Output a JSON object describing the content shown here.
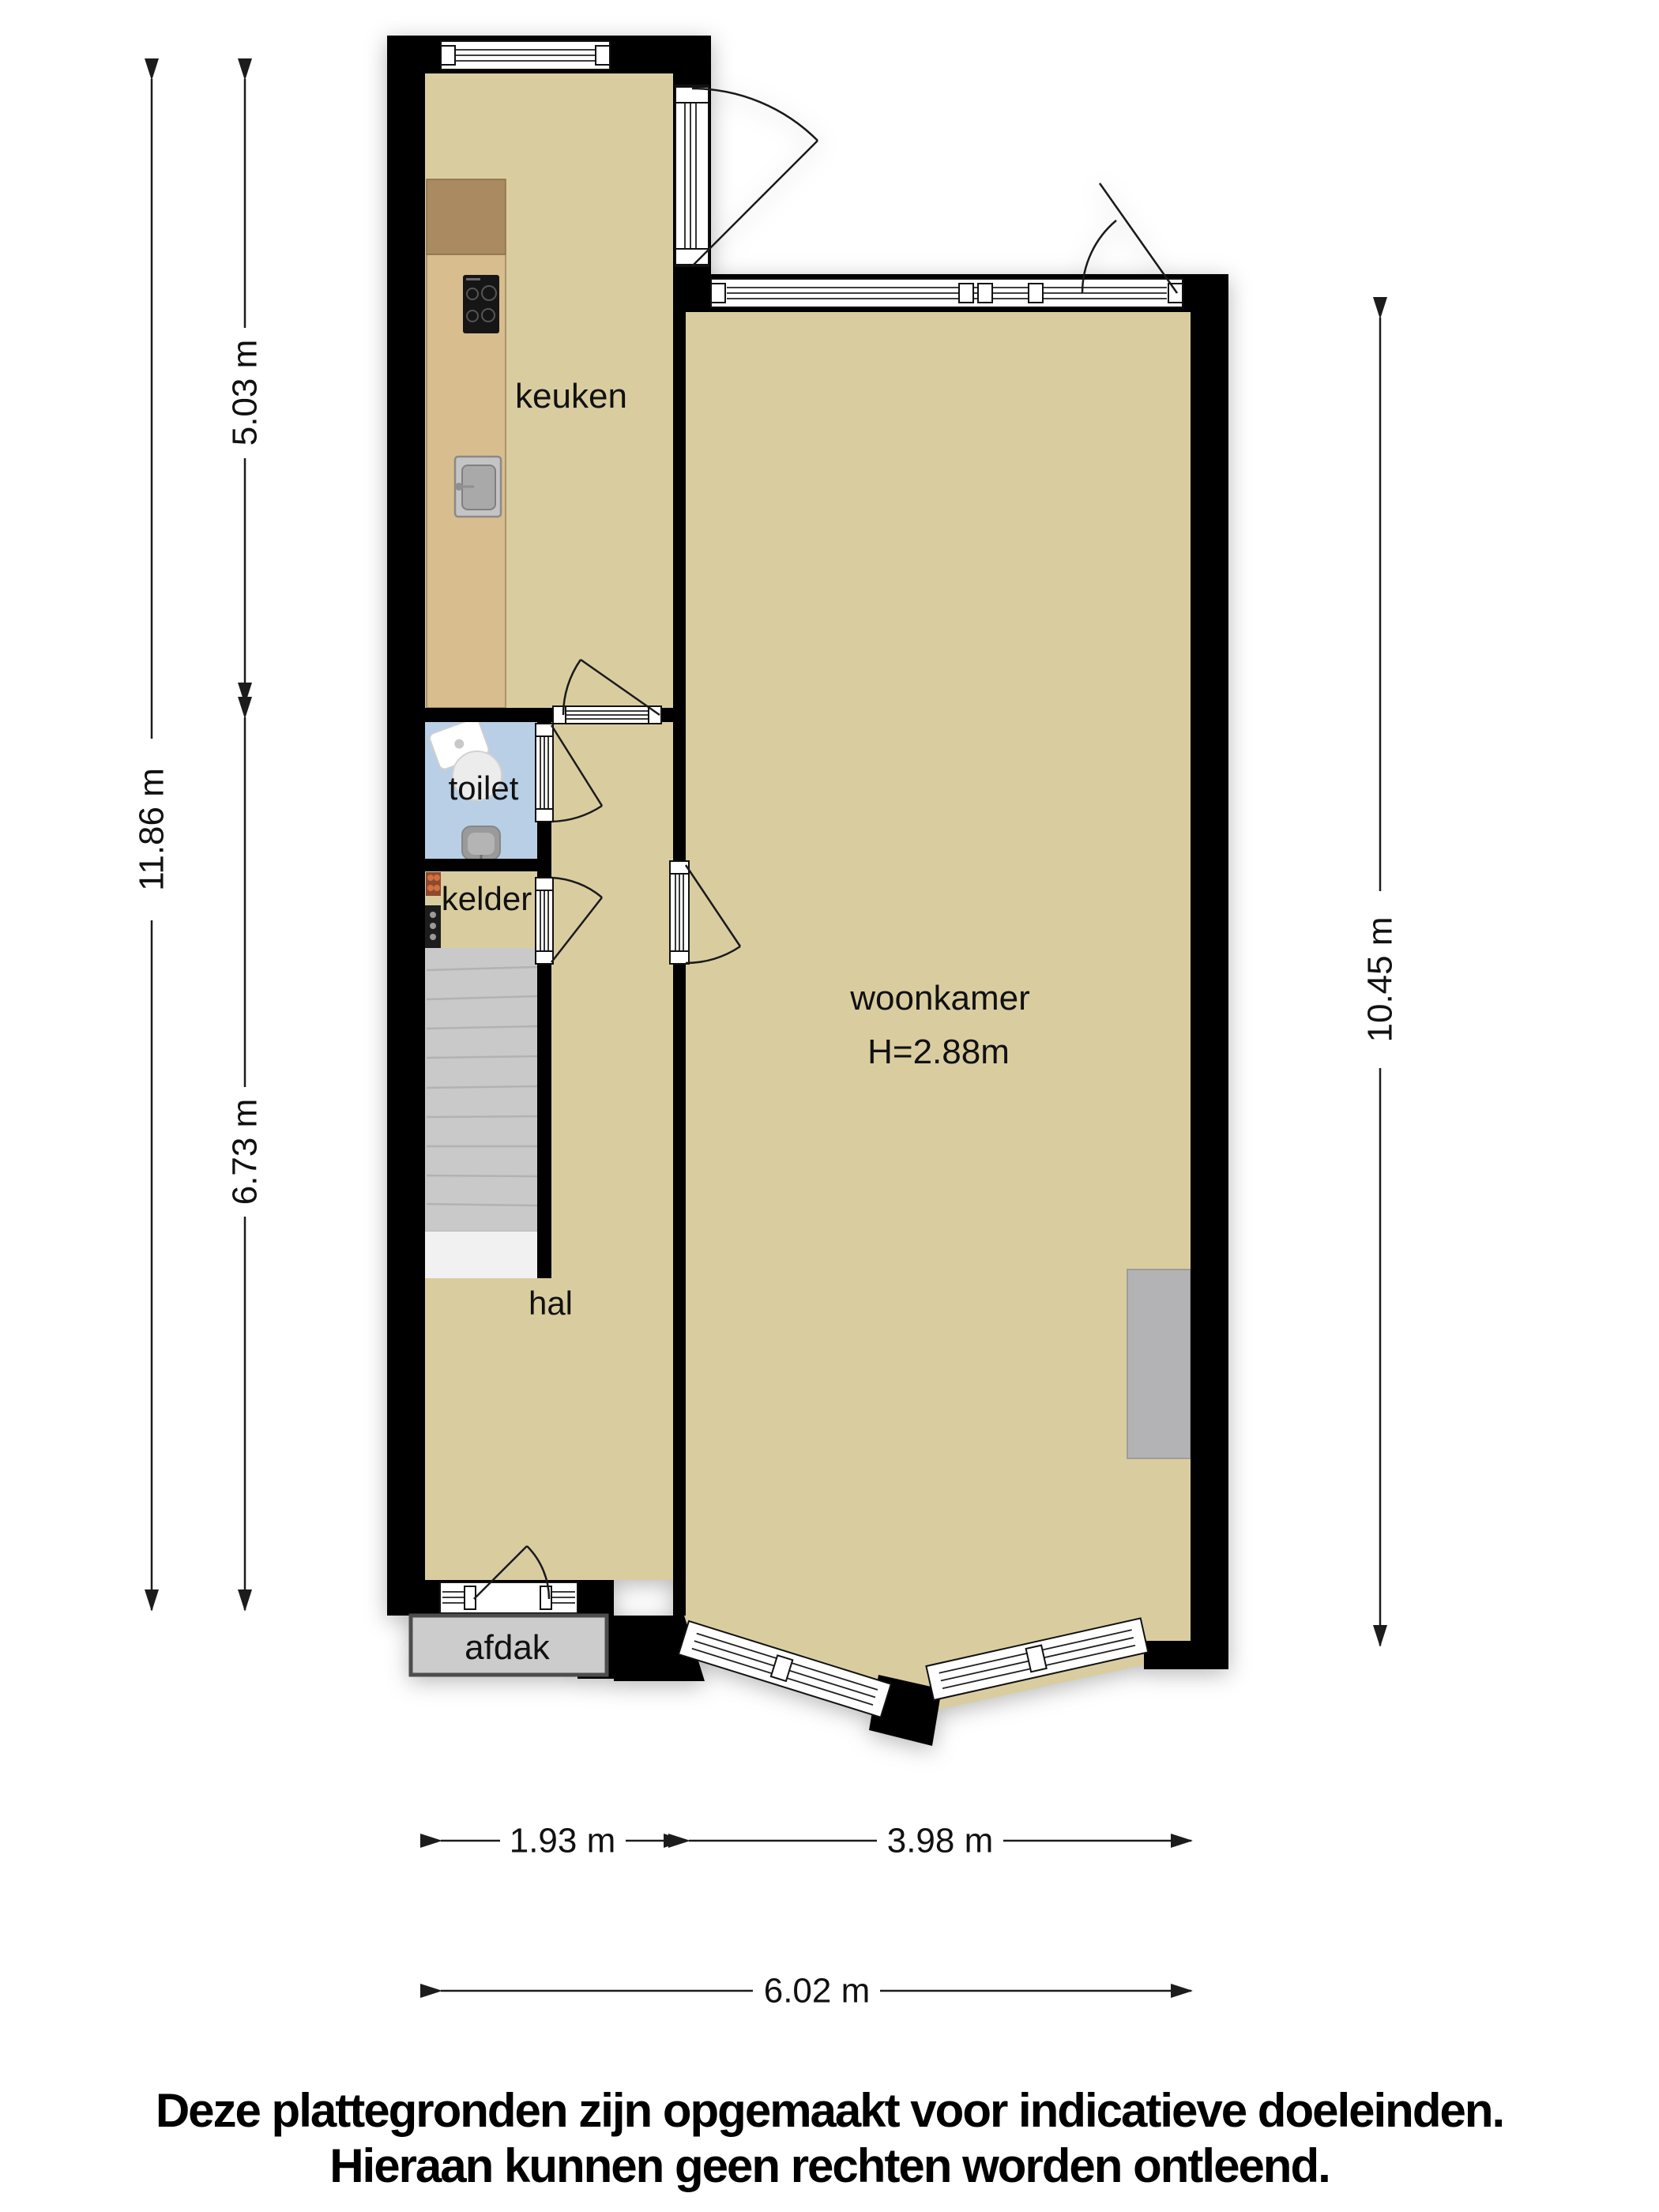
{
  "floorplan": {
    "rooms": {
      "keuken": {
        "label": "keuken"
      },
      "toilet": {
        "label": "toilet"
      },
      "kelder": {
        "label": "kelder"
      },
      "hal": {
        "label": "hal"
      },
      "woonkamer": {
        "label": "woonkamer",
        "ceiling_height": "H=2.88m"
      },
      "afdak": {
        "label": "afdak"
      }
    },
    "dimensions": {
      "left_total": "11.86 m",
      "left_upper": "5.03 m",
      "left_lower": "6.73 m",
      "right_total": "10.45 m",
      "bottom_left": "1.93 m",
      "bottom_right": "3.98 m",
      "bottom_total": "6.02 m"
    },
    "disclaimer": {
      "line1": "Deze plattegronden zijn opgemaakt voor indicatieve doeleinden.",
      "line2": "Hieraan kunnen geen rechten worden ontleend."
    },
    "colors": {
      "wall": "#000000",
      "floor": "#d9cda0",
      "toilet_floor": "#b8cfe6",
      "counter_light": "#d8bd8e",
      "counter_dark": "#aa8a60",
      "stairs": "#c9c9c9",
      "landing": "#f1f1f1",
      "afdak": "#cccccc",
      "unit_gray": "#b3b3b6"
    }
  }
}
